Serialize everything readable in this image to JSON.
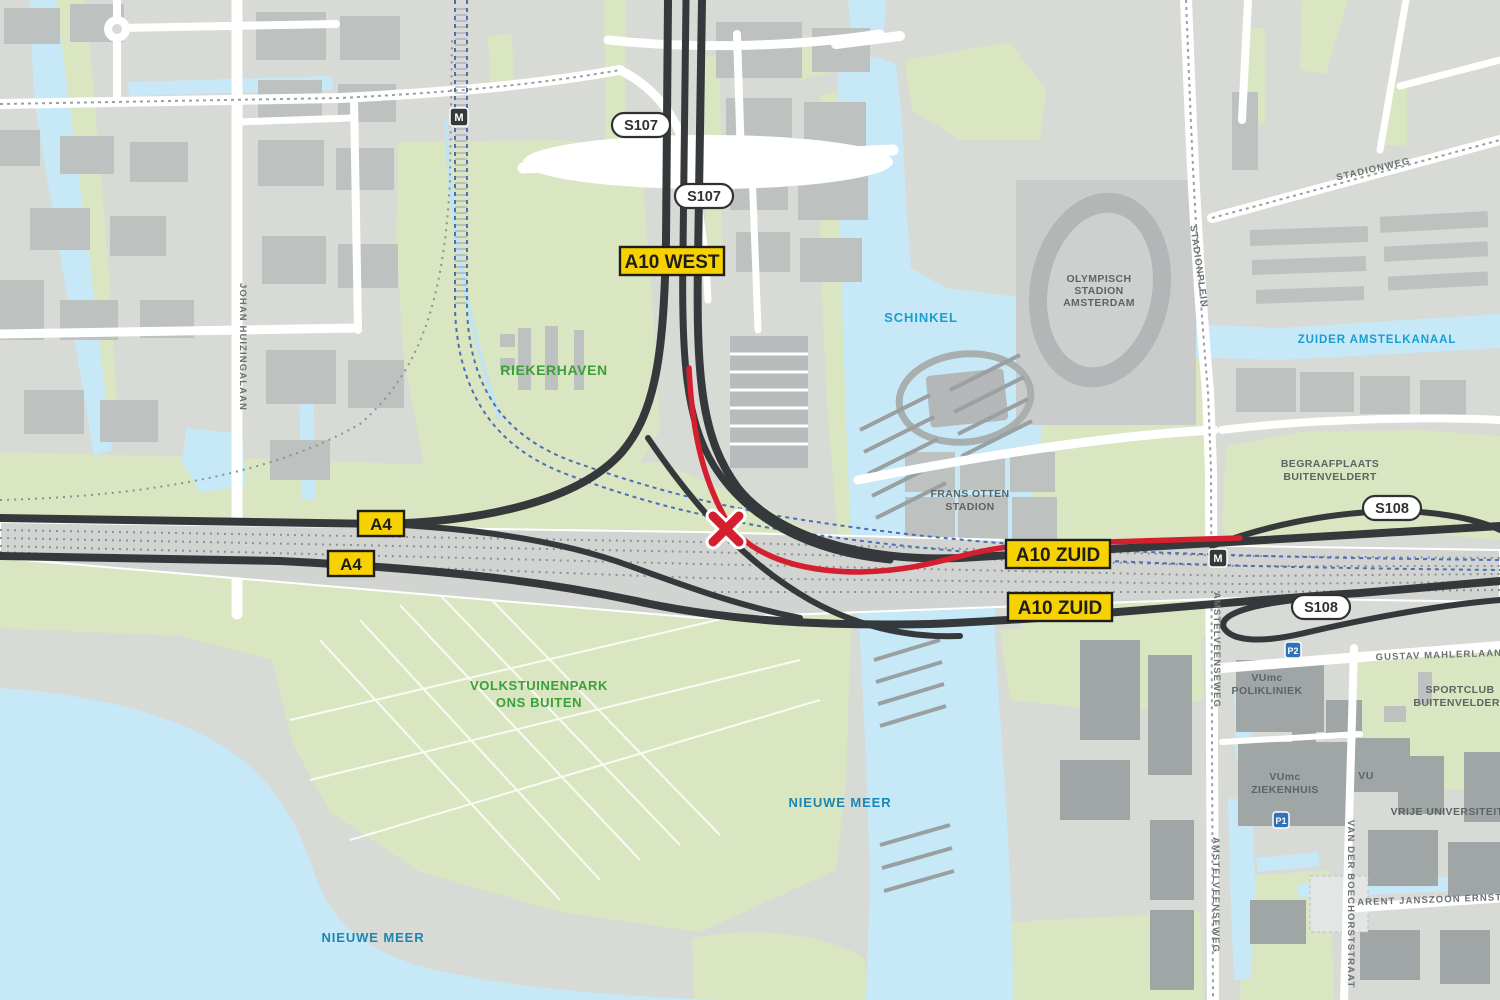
{
  "map": {
    "route_badges": {
      "a10_west": "A10 WEST",
      "a4": "A4",
      "a10_zuid": "A10 ZUID"
    },
    "shields": {
      "s107": "S107",
      "s108": "S108"
    },
    "icons": {
      "metro": "M",
      "parking_p1": "P1",
      "parking_p2": "P2"
    },
    "water_labels": {
      "schinkel": "SCHINKEL",
      "nieuwe_meer": "NIEUWE MEER",
      "zuider_amstelkanaal": "ZUIDER AMSTELKANAAL"
    },
    "park_labels": {
      "riekerhaven": "RIEKERHAVEN",
      "volkstuinenpark": "VOLKSTUINENPARK",
      "ons_buiten": "ONS BUITEN"
    },
    "place_labels": {
      "olympisch_l1": "OLYMPISCH",
      "olympisch_l2": "STADION",
      "olympisch_l3": "AMSTERDAM",
      "frans_otten_l1": "FRANS OTTEN",
      "frans_otten_l2": "STADION",
      "begraafplaats_l1": "BEGRAAFPLAATS",
      "begraafplaats_l2": "BUITENVELDERT",
      "sportclub_l1": "SPORTCLUB",
      "sportclub_l2": "BUITENVELDERT",
      "vumc_polikliniek_l1": "VUmc",
      "vumc_polikliniek_l2": "POLIKLINIEK",
      "vumc_ziekenhuis_l1": "VUmc",
      "vumc_ziekenhuis_l2": "ZIEKENHUIS",
      "vu": "VU",
      "vrije_universiteit": "VRIJE UNIVERSITEIT"
    },
    "street_labels": {
      "johan_huizingalaan": "JOHAN HUIZINGALAAN",
      "stadionweg": "STADIONWEG",
      "stadionplein": "STADIONPLEIN",
      "amstelveenseweg": "AMSTELVEENSEWEG",
      "gustav_mahlerlaan": "GUSTAV MAHLERLAAN",
      "arent_janszoon_ernststraat": "ARENT JANSZOON ERNSTSTRAAT",
      "van_der_boechorststraat": "VAN DER BOECHORSTSTRAAT"
    },
    "colors": {
      "closure_red": "#d41f2f",
      "badge_yellow": "#f8d200",
      "highway_dark": "#36393b",
      "water_blue": "#c6e8f7",
      "park_green": "#d9e6c1",
      "land_gray": "#d8dad6",
      "building_gray": "#bdc1c0",
      "water_label_blue": "#199fce",
      "park_label_green": "#3aa03a"
    }
  }
}
